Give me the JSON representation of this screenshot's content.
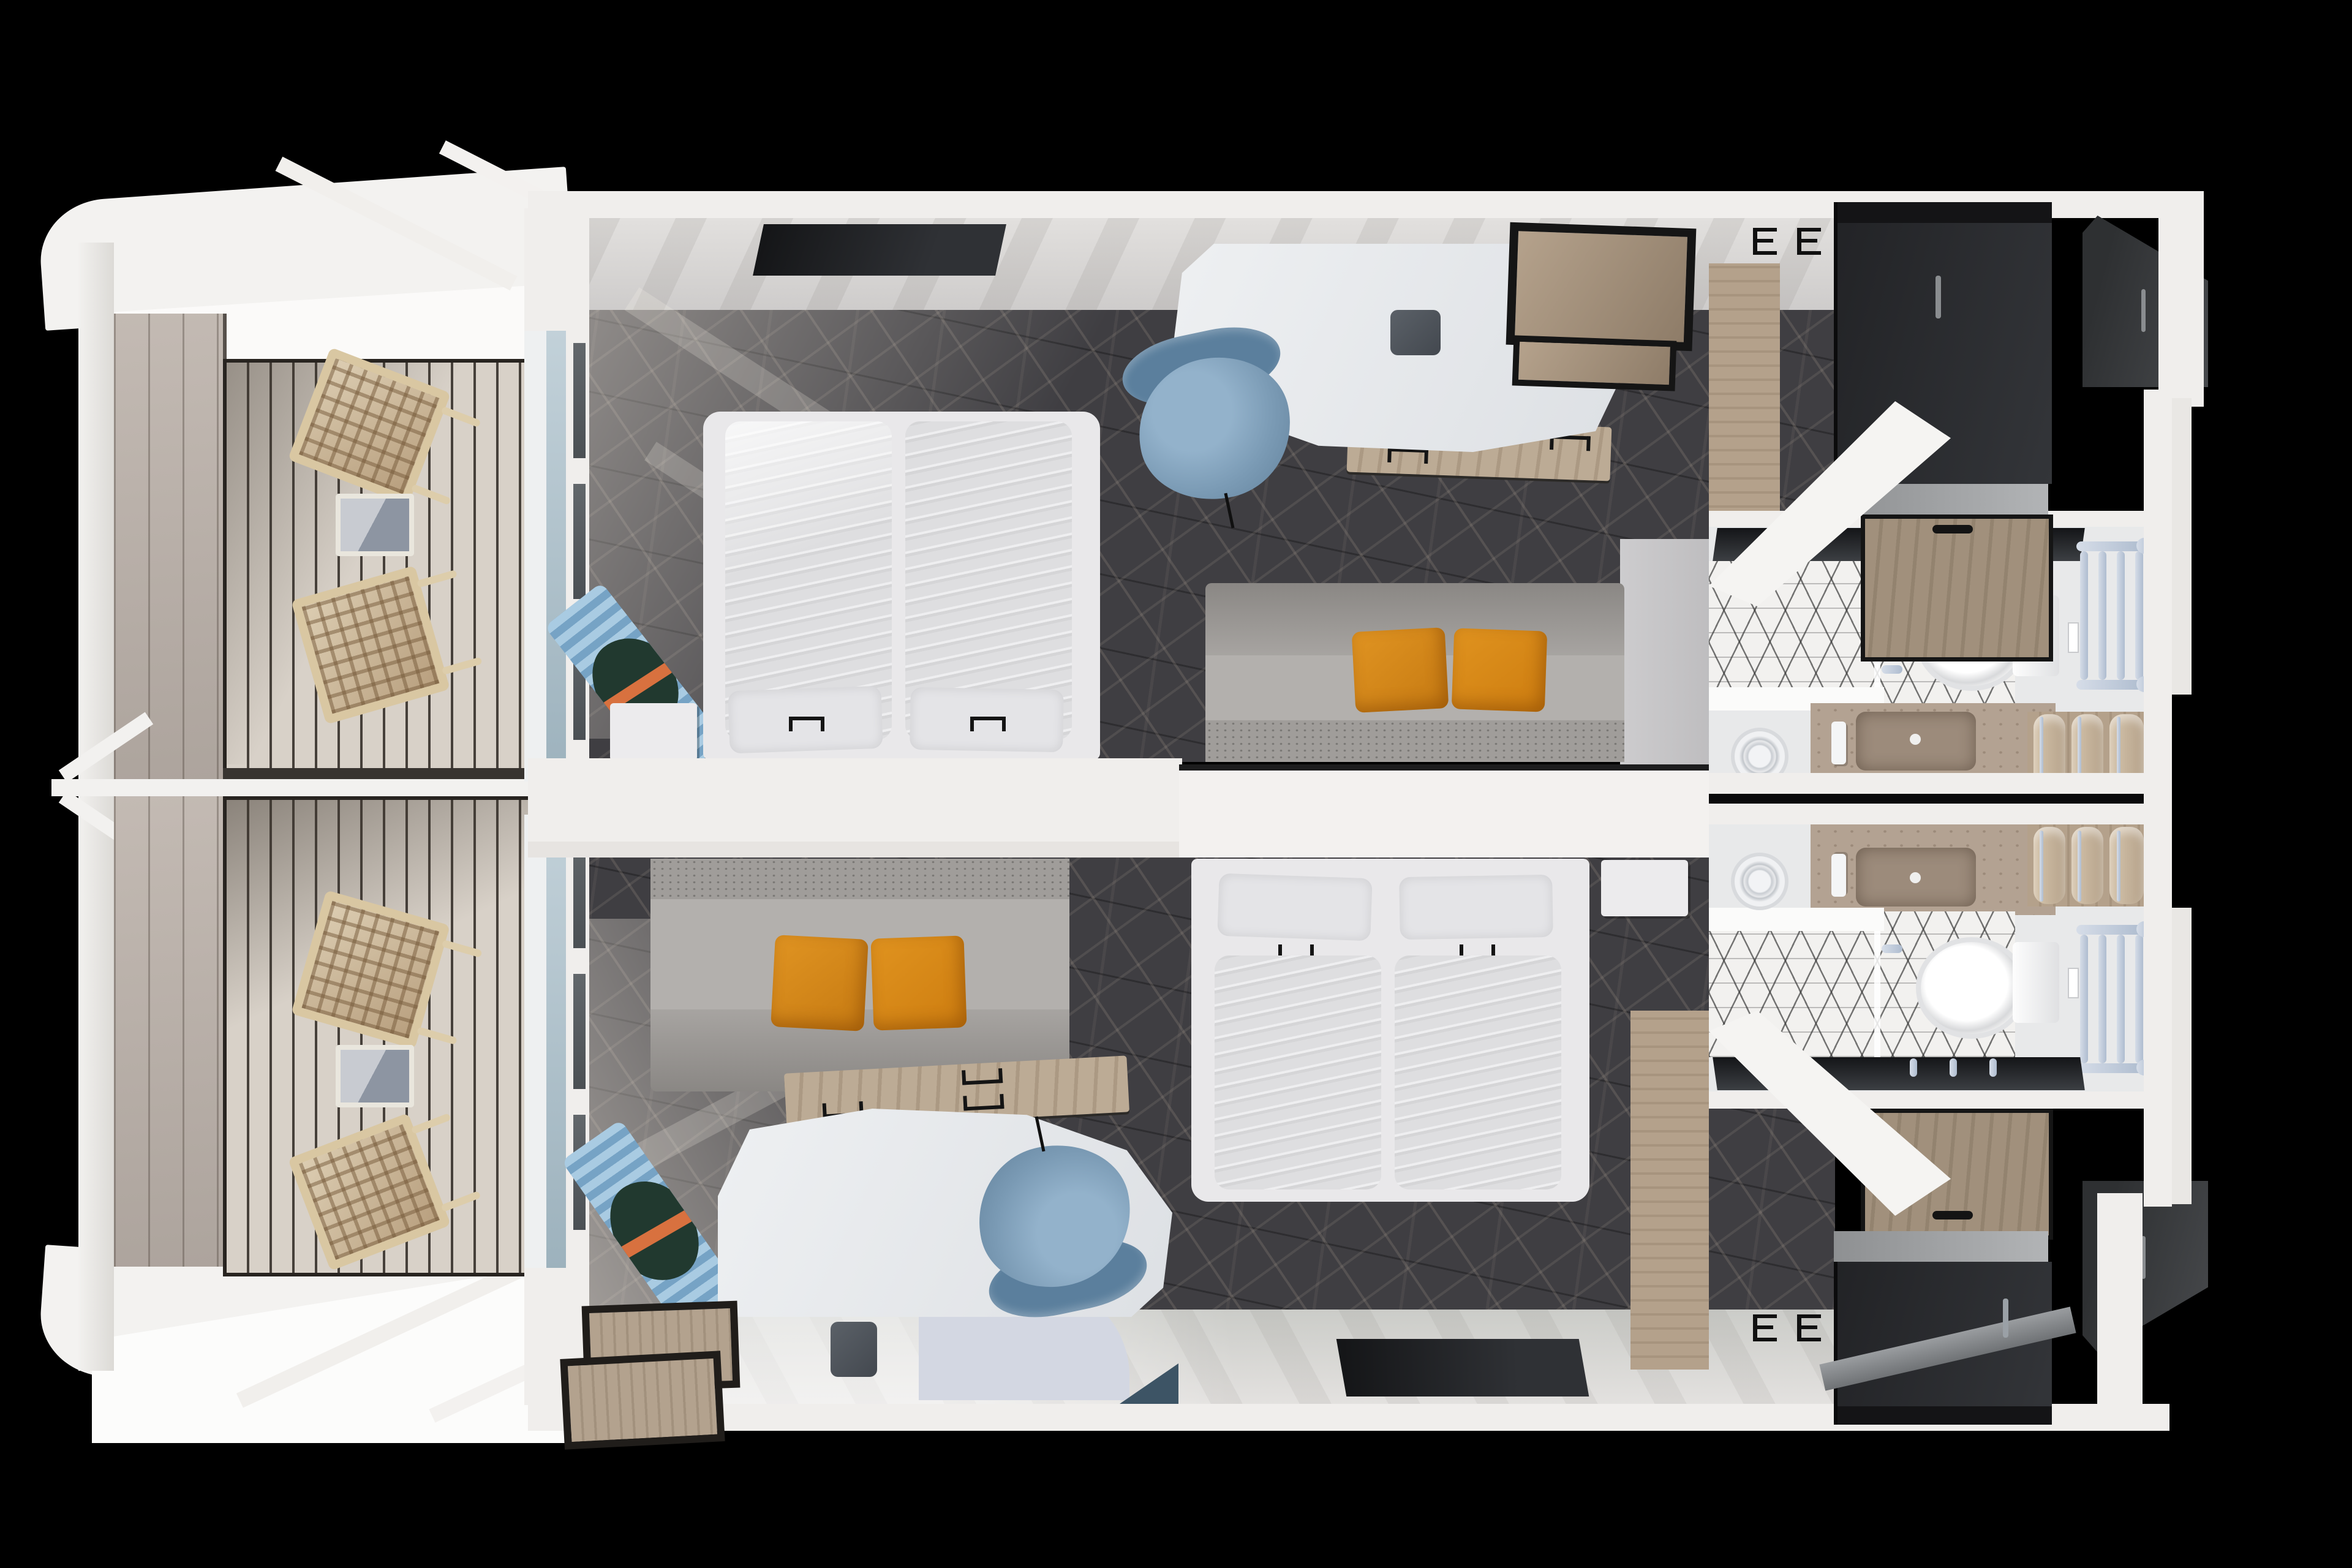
{
  "scene": {
    "description": "Top-down 3D rendered floor plan of two mirrored cruise-ship balcony staterooms with en-suite bathrooms",
    "view": "overhead render on black background",
    "visible_text": "",
    "background": "#000000"
  },
  "palette": {
    "background": "#000000",
    "wall_white": "#f0eeec",
    "wall_bright": "#fbfaf9",
    "wall_face_gray": "#d6d4d2",
    "hull_white": "#f3f2f0",
    "bulwark_gray": "#b9b0a9",
    "deck_plank": "#d8d1c8",
    "deck_frame": "#282420",
    "carpet_dark": "#3f3e42",
    "carpet_thread": "#c4b5a4",
    "tv_black": "#1b1c1f",
    "bed_frame_white": "#e9e8ea",
    "mattress_white": "#dedee0",
    "pillow_white": "#e4e4e7",
    "sofa_gray": "#aaa7a4",
    "pillow_orange": "#d8891d",
    "desk_white": "#e9ebee",
    "drawer_wood": "#b4a18b",
    "chair_blue": "#7d9cb6",
    "handle_black": "#141414",
    "wardrobe_charcoal": "#2a2b2d",
    "closet_wood": "#a0907b",
    "tile_white": "#f2f1ef",
    "tile_line": "#2f2f2f",
    "vanity_stone": "#b3a292",
    "sink_stone": "#9c8b7b",
    "toilet_white": "#fafafa",
    "chrome_blue": "#c2cedd",
    "towel_tan": "#c9b69e",
    "glass_blue": "#b7c6cf",
    "glass_dark": "#5a5f63",
    "door_white": "#f5f4f2",
    "curtain_blue": "#93bad8",
    "curtain_green": "#21392f",
    "curtain_orange": "#d8713f",
    "nightstand_white": "#ecebed",
    "box_wood": "#b3a28e",
    "lit_floor": "#c9cac6",
    "curved_cabinet": "#d3d7e2"
  },
  "inventory": {
    "balconies": [
      {
        "id": "top",
        "lounge_chairs": 2,
        "side_table": 1,
        "deck": "wood plank decking",
        "divider": "partition fin"
      },
      {
        "id": "bottom",
        "lounge_chairs": 2,
        "side_table": 1,
        "deck": "wood plank decking",
        "divider": "partition fin"
      }
    ],
    "cabins": [
      {
        "id": "top",
        "bed_mattresses": 2,
        "bed_pillows": 2,
        "sofa_pillows": 2,
        "furniture": [
          "double-bed",
          "nightstand",
          "sofa",
          "desk",
          "desk-drawers",
          "desk-chair",
          "tv",
          "minibar-shelf",
          "wall-hooks",
          "curtains",
          "wardrobe"
        ]
      },
      {
        "id": "bottom",
        "bed_mattresses": 2,
        "bed_pillows": 2,
        "sofa_pillows": 2,
        "furniture": [
          "double-bed",
          "nightstand",
          "sofa",
          "desk",
          "desk-drawers",
          "desk-chair",
          "tv",
          "storage-boxes",
          "wall-hooks",
          "curtains",
          "wardrobe",
          "small-cube"
        ]
      }
    ],
    "bathrooms": [
      {
        "id": "top",
        "fixtures": [
          "toilet",
          "vanity-sink",
          "faucet",
          "mixer-handles",
          "shower",
          "glass-partition",
          "towel-ladder",
          "towels"
        ],
        "towels": 3,
        "ladder_rungs": 4
      },
      {
        "id": "bottom",
        "fixtures": [
          "toilet",
          "vanity-sink",
          "faucet",
          "mixer-handles",
          "shower",
          "glass-partition",
          "towel-ladder",
          "towels"
        ],
        "towels": 3,
        "ladder_rungs": 4
      }
    ]
  }
}
